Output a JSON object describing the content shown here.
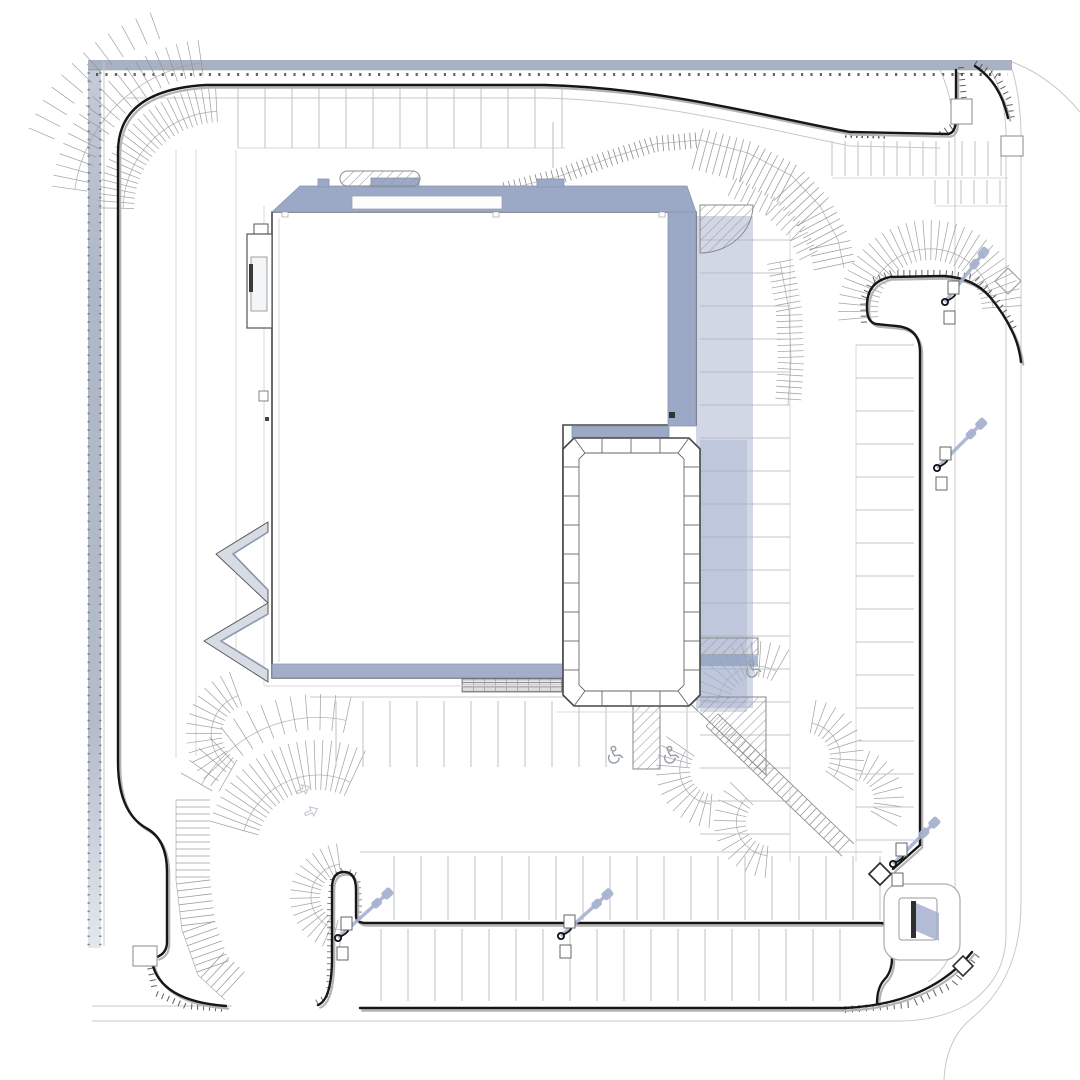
{
  "meta": {
    "drawing": "architectural-site-plan",
    "width": 1080,
    "height": 1080,
    "visible_text": "none"
  },
  "palette": {
    "background": "#ffffff",
    "roof_band": "#9ca9c6",
    "building_shadow": "#a4b0cc",
    "pole_shadow": "#a7b2cf",
    "curb_black": "#161616",
    "curb_shadow": "#b3b3b3",
    "stall_line": "#c4c6c9",
    "fan_line": "#8f8f8f",
    "tick_dark": "#4a4a4a",
    "icon_gray": "#97a0ab",
    "left_road_band": "#b2bac8",
    "top_road_band": "#a9b2c3"
  },
  "icons": [
    "wheelchair-icon",
    "light-pole-icon",
    "curb-ramp-diamond-icon",
    "monument-sign-icon",
    "traffic-arrow-icon"
  ],
  "parking": {
    "rows": [
      {
        "name": "top-row-west",
        "type": "v",
        "x0": 238,
        "y0": 84,
        "depth": 64,
        "count": 13,
        "dx": 27
      },
      {
        "name": "top-row-east",
        "type": "v",
        "x0": 832,
        "y0": 141,
        "depth": 35,
        "count": 14,
        "dx": 13
      },
      {
        "name": "top-row-east-2",
        "type": "v",
        "x0": 935,
        "y0": 180,
        "depth": 24,
        "count": 6,
        "dx": 13
      },
      {
        "name": "right-field-west",
        "type": "h",
        "x0": 700,
        "y0": 240,
        "depth": 90,
        "count": 19,
        "dy": 33
      },
      {
        "name": "right-field-east",
        "type": "h",
        "x0": 856,
        "y0": 345,
        "depth": 58,
        "count": 16,
        "dy": 33
      },
      {
        "name": "center-row",
        "type": "v",
        "x0": 336,
        "y0": 701,
        "depth": 66,
        "count": 14,
        "dx": 27
      },
      {
        "name": "bottom-row-upper",
        "type": "v",
        "x0": 394,
        "y0": 856,
        "depth": 64,
        "count": 19,
        "dx": 27
      },
      {
        "name": "bottom-row-lower",
        "type": "v",
        "x0": 381,
        "y0": 929,
        "depth": 72,
        "count": 18,
        "dx": 27
      }
    ]
  },
  "slope_fans": [
    {
      "cx": 222,
      "cy": 210,
      "r0": 88,
      "r1": 124,
      "a0": 181,
      "a1": 267,
      "n": 26,
      "arc": 0.3
    },
    {
      "cx": 222,
      "cy": 210,
      "r0": 136,
      "r1": 172,
      "a0": 188,
      "a1": 262,
      "n": 20,
      "arc": 0.35
    },
    {
      "cx": 222,
      "cy": 210,
      "r0": 182,
      "r1": 210,
      "a0": 203,
      "a1": 250,
      "n": 11
    },
    {
      "cx": 930,
      "cy": 312,
      "r0": 52,
      "r1": 92,
      "a0": 175,
      "a1": 356,
      "n": 34,
      "arc": 0.28
    },
    {
      "cx": 318,
      "cy": 852,
      "r0": 62,
      "r1": 112,
      "a0": 196,
      "a1": 295,
      "n": 22,
      "arc": 0.3
    },
    {
      "cx": 318,
      "cy": 852,
      "r0": 122,
      "r1": 158,
      "a0": 210,
      "a1": 282,
      "n": 13,
      "arc": 0.35
    },
    {
      "cx": 252,
      "cy": 734,
      "r0": 30,
      "r1": 66,
      "a0": 120,
      "a1": 250,
      "n": 15,
      "arc": 0.3
    },
    {
      "cx": 344,
      "cy": 897,
      "r0": 24,
      "r1": 54,
      "a0": 95,
      "a1": 262,
      "n": 18,
      "arc": 0.3
    },
    {
      "cx": 757,
      "cy": 705,
      "r0": 28,
      "r1": 64,
      "a0": 185,
      "a1": 300,
      "n": 13,
      "arc": 0.3
    },
    {
      "cx": 714,
      "cy": 770,
      "r0": 24,
      "r1": 58,
      "a0": 95,
      "a1": 215,
      "n": 12,
      "arc": 0.3
    },
    {
      "cx": 806,
      "cy": 757,
      "r0": 24,
      "r1": 58,
      "a0": 280,
      "a1": 395,
      "n": 11,
      "arc": 0.3
    },
    {
      "cx": 770,
      "cy": 822,
      "r0": 24,
      "r1": 56,
      "a0": 95,
      "a1": 225,
      "n": 12,
      "arc": 0.3
    },
    {
      "cx": 852,
      "cy": 800,
      "r0": 22,
      "r1": 52,
      "a0": 290,
      "a1": 390,
      "n": 9
    }
  ],
  "tick_paths": [
    {
      "name": "berm-s-band",
      "pts": [
        [
          505,
          190
        ],
        [
          560,
          176
        ],
        [
          610,
          158
        ],
        [
          655,
          144
        ],
        [
          700,
          140
        ]
      ],
      "len": 16,
      "step": 5.5,
      "side": 0,
      "color": "#777777",
      "width": 0.8,
      "arc": true
    },
    {
      "name": "berm-arc-main",
      "pts": [
        [
          700,
          140
        ],
        [
          748,
          153
        ],
        [
          792,
          176
        ],
        [
          820,
          206
        ],
        [
          838,
          240
        ],
        [
          844,
          268
        ]
      ],
      "len": 30,
      "step": 7,
      "side": -1,
      "color": "#8f8f8f",
      "width": 0.8,
      "arc": true
    },
    {
      "name": "berm-arc-main-in",
      "pts": [
        [
          700,
          140
        ],
        [
          748,
          153
        ],
        [
          792,
          176
        ],
        [
          820,
          206
        ],
        [
          838,
          240
        ],
        [
          844,
          268
        ]
      ],
      "len": 12,
      "step": 7,
      "side": 1,
      "color": "#8f8f8f",
      "width": 0.8
    },
    {
      "name": "berm-arc-inner",
      "pts": [
        [
          737,
          178
        ],
        [
          775,
          197
        ],
        [
          805,
          226
        ],
        [
          820,
          256
        ]
      ],
      "len": 20,
      "step": 7,
      "side": -1,
      "color": "#9a9a9a",
      "width": 0.8
    },
    {
      "name": "berm-vertical-tail",
      "pts": [
        [
          780,
          262
        ],
        [
          789,
          310
        ],
        [
          791,
          360
        ],
        [
          788,
          405
        ]
      ],
      "len": 26,
      "step": 6,
      "side": 0,
      "color": "#9a9a9a",
      "width": 0.8,
      "arc": true
    },
    {
      "name": "left-berm-band",
      "pts": [
        [
          176,
          800
        ],
        [
          176,
          880
        ],
        [
          182,
          930
        ],
        [
          198,
          975
        ],
        [
          225,
          1000
        ]
      ],
      "len": 34,
      "step": 7,
      "side": 1,
      "color": "#8f8f8f",
      "width": 0.8,
      "arc": true
    },
    {
      "name": "curb-hatch-ne-1",
      "pts": [
        [
          958,
          68
        ],
        [
          961,
          100
        ],
        [
          953,
          122
        ],
        [
          938,
          132
        ]
      ],
      "len": 6,
      "step": 6,
      "side": 1,
      "color": "#444444",
      "width": 1
    },
    {
      "name": "curb-hatch-ne-2",
      "pts": [
        [
          974,
          66
        ],
        [
          995,
          79
        ],
        [
          1006,
          100
        ],
        [
          1009,
          120
        ]
      ],
      "len": 6,
      "step": 6,
      "side": 1,
      "color": "#444444",
      "width": 1
    },
    {
      "name": "curb-hatch-island",
      "pts": [
        [
          867,
          322
        ],
        [
          866,
          300
        ],
        [
          874,
          283
        ],
        [
          892,
          276
        ],
        [
          944,
          276
        ],
        [
          974,
          280
        ],
        [
          990,
          297
        ],
        [
          1004,
          316
        ],
        [
          1014,
          334
        ]
      ],
      "len": 6,
      "step": 6,
      "side": 1,
      "color": "#444444",
      "width": 1
    },
    {
      "name": "curb-hatch-se",
      "pts": [
        [
          845,
          1006
        ],
        [
          910,
          1001
        ],
        [
          952,
          981
        ],
        [
          974,
          953
        ]
      ],
      "len": 7,
      "step": 7,
      "side": -1,
      "color": "#444444",
      "width": 1
    },
    {
      "name": "curb-hatch-sw-1",
      "pts": [
        [
          152,
          962
        ],
        [
          158,
          991
        ],
        [
          186,
          1003
        ],
        [
          226,
          1006
        ]
      ],
      "len": 6,
      "step": 6,
      "side": -1,
      "color": "#444444",
      "width": 1
    },
    {
      "name": "curb-hatch-sw-2",
      "pts": [
        [
          318,
          1004
        ],
        [
          331,
          997
        ],
        [
          332,
          964
        ],
        [
          332,
          905
        ],
        [
          335,
          878
        ],
        [
          344,
          872
        ],
        [
          355,
          877
        ],
        [
          357,
          903
        ],
        [
          357,
          920
        ]
      ],
      "len": 5,
      "step": 6,
      "side": 1,
      "color": "#555555",
      "width": 0.9
    }
  ],
  "stair_walkway": {
    "x1": 712,
    "y1": 720,
    "x2": 848,
    "y2": 850,
    "width": 17,
    "step": 6.5
  },
  "light_poles": [
    {
      "x": 945,
      "y": 302,
      "len": 62,
      "angle": -52
    },
    {
      "x": 937,
      "y": 468,
      "len": 62,
      "angle": -45
    },
    {
      "x": 893,
      "y": 864,
      "len": 58,
      "angle": -45
    },
    {
      "x": 338,
      "y": 938,
      "len": 66,
      "angle": -42
    },
    {
      "x": 561,
      "y": 936,
      "len": 62,
      "angle": -42
    }
  ],
  "accessible_parking": {
    "icon": "wheelchair-icon",
    "positions": [
      [
        614,
        757
      ],
      [
        670,
        757
      ],
      [
        752,
        671
      ]
    ]
  },
  "traffic_arrows": [
    [
      295,
      788
    ],
    [
      303,
      810
    ]
  ]
}
